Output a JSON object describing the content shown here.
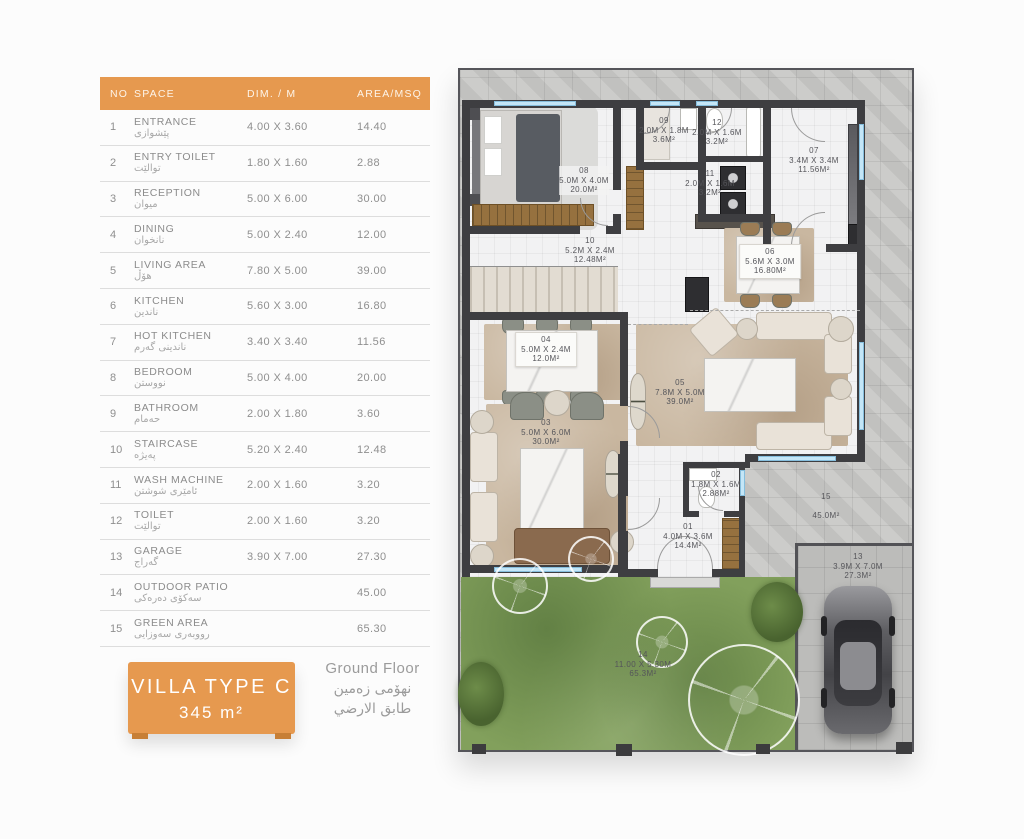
{
  "table": {
    "headers": {
      "no": "NO",
      "space": "SPACE",
      "dim": "DIM. / M",
      "area": "AREA/MSQ"
    },
    "rows": [
      {
        "no": "1",
        "space": "ENTRANCE",
        "local": "پێشوازی",
        "dim": "4.00 X 3.60",
        "area": "14.40"
      },
      {
        "no": "2",
        "space": "ENTRY TOILET",
        "local": "توالێت",
        "dim": "1.80 X 1.60",
        "area": "2.88"
      },
      {
        "no": "3",
        "space": "RECEPTION",
        "local": "میوان",
        "dim": "5.00 X 6.00",
        "area": "30.00"
      },
      {
        "no": "4",
        "space": "DINING",
        "local": "نانخوان",
        "dim": "5.00 X 2.40",
        "area": "12.00"
      },
      {
        "no": "5",
        "space": "LIVING AREA",
        "local": "هۆڵ",
        "dim": "7.80 X 5.00",
        "area": "39.00"
      },
      {
        "no": "6",
        "space": "KITCHEN",
        "local": "ناندین",
        "dim": "5.60 X 3.00",
        "area": "16.80"
      },
      {
        "no": "7",
        "space": "HOT KITCHEN",
        "local": "ناندینی گەرم",
        "dim": "3.40 X 3.40",
        "area": "11.56"
      },
      {
        "no": "8",
        "space": "BEDROOM",
        "local": "نووستن",
        "dim": "5.00 X 4.00",
        "area": "20.00"
      },
      {
        "no": "9",
        "space": "BATHROOM",
        "local": "حەمام",
        "dim": "2.00 X 1.80",
        "area": "3.60"
      },
      {
        "no": "10",
        "space": "STAIRCASE",
        "local": "پەیژە",
        "dim": "5.20 X 2.40",
        "area": "12.48"
      },
      {
        "no": "11",
        "space": "WASH MACHINE",
        "local": "ئامێری شوشتن",
        "dim": "2.00 X 1.60",
        "area": "3.20"
      },
      {
        "no": "12",
        "space": "TOILET",
        "local": "توالێت",
        "dim": "2.00 X 1.60",
        "area": "3.20"
      },
      {
        "no": "13",
        "space": "GARAGE",
        "local": "گەراج",
        "dim": "3.90 X 7.00",
        "area": "27.30"
      },
      {
        "no": "14",
        "space": "OUTDOOR PATIO",
        "local": "سەکۆی دەرەکی",
        "dim": "",
        "area": "45.00"
      },
      {
        "no": "15",
        "space": "GREEN AREA",
        "local": "رووبەری سەوزایی",
        "dim": "",
        "area": "65.30"
      }
    ]
  },
  "badge": {
    "line1": "VILLA TYPE C",
    "line2": "345 m²"
  },
  "floor": {
    "en": "Ground Floor",
    "ku": "نهۆمی زەمین",
    "ar": "طابق الارضي"
  },
  "plan": {
    "labels": [
      {
        "no": "01",
        "dim": "4.0M X 3.6M",
        "area": "14.4M²"
      },
      {
        "no": "02",
        "dim": "1.8M X 1.6M",
        "area": "2.88M²"
      },
      {
        "no": "03",
        "dim": "5.0M X 6.0M",
        "area": "30.0M²"
      },
      {
        "no": "04",
        "dim": "5.0M X 2.4M",
        "area": "12.0M²"
      },
      {
        "no": "05",
        "dim": "7.8M X 5.0M",
        "area": "39.0M²"
      },
      {
        "no": "06",
        "dim": "5.6M X 3.0M",
        "area": "16.80M²"
      },
      {
        "no": "07",
        "dim": "3.4M X 3.4M",
        "area": "11.56M²"
      },
      {
        "no": "08",
        "dim": "5.0M X 4.0M",
        "area": "20.0M²"
      },
      {
        "no": "09",
        "dim": "2.0M X 1.8M",
        "area": "3.6M²"
      },
      {
        "no": "10",
        "dim": "5.2M X 2.4M",
        "area": "12.48M²"
      },
      {
        "no": "11",
        "dim": "2.0M X 1.6M",
        "area": "3.2M²"
      },
      {
        "no": "12",
        "dim": "2.0M X 1.6M",
        "area": "3.2M²"
      },
      {
        "no": "13",
        "dim": "3.9M X 7.0M",
        "area": "27.3M²"
      },
      {
        "no": "14",
        "dim": "11.00 X 5.30M",
        "area": "65.3M²"
      },
      {
        "no": "15",
        "dim": "",
        "area": "45.0M²"
      }
    ]
  },
  "colors": {
    "accent": "#E6994F",
    "wall": "#3E3E41",
    "window": "#C4E6F7",
    "garden": "#82A05C",
    "tile": "#C9C9C7"
  }
}
